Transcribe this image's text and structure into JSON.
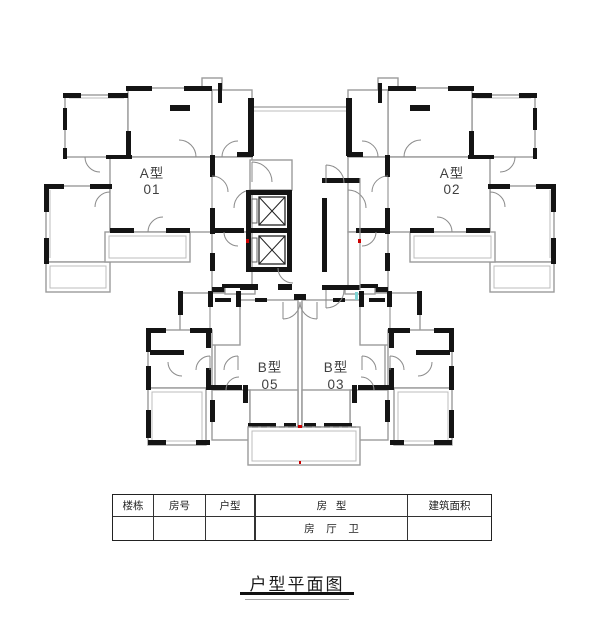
{
  "page": {
    "background": "#ffffff"
  },
  "plan": {
    "units": [
      {
        "id": "a-01",
        "type_label": "A型",
        "number": "01"
      },
      {
        "id": "a-02",
        "type_label": "A型",
        "number": "02"
      },
      {
        "id": "b-05",
        "type_label": "B型",
        "number": "05"
      },
      {
        "id": "b-03",
        "type_label": "B型",
        "number": "03"
      }
    ],
    "elevator_count": 2,
    "colors": {
      "wall_black": "#141414",
      "wall_gray": "#9b9b9b",
      "door_arc": "#8a8a8a",
      "marker_red": "#cc0000",
      "marker_teal": "#7fd4d4"
    }
  },
  "table": {
    "headers": [
      "楼栋",
      "房号",
      "户型",
      "房   型",
      "建筑面积"
    ],
    "subrow": {
      "room_type_detail": "房    厅    卫"
    }
  },
  "title": {
    "text": "户型平面图"
  }
}
